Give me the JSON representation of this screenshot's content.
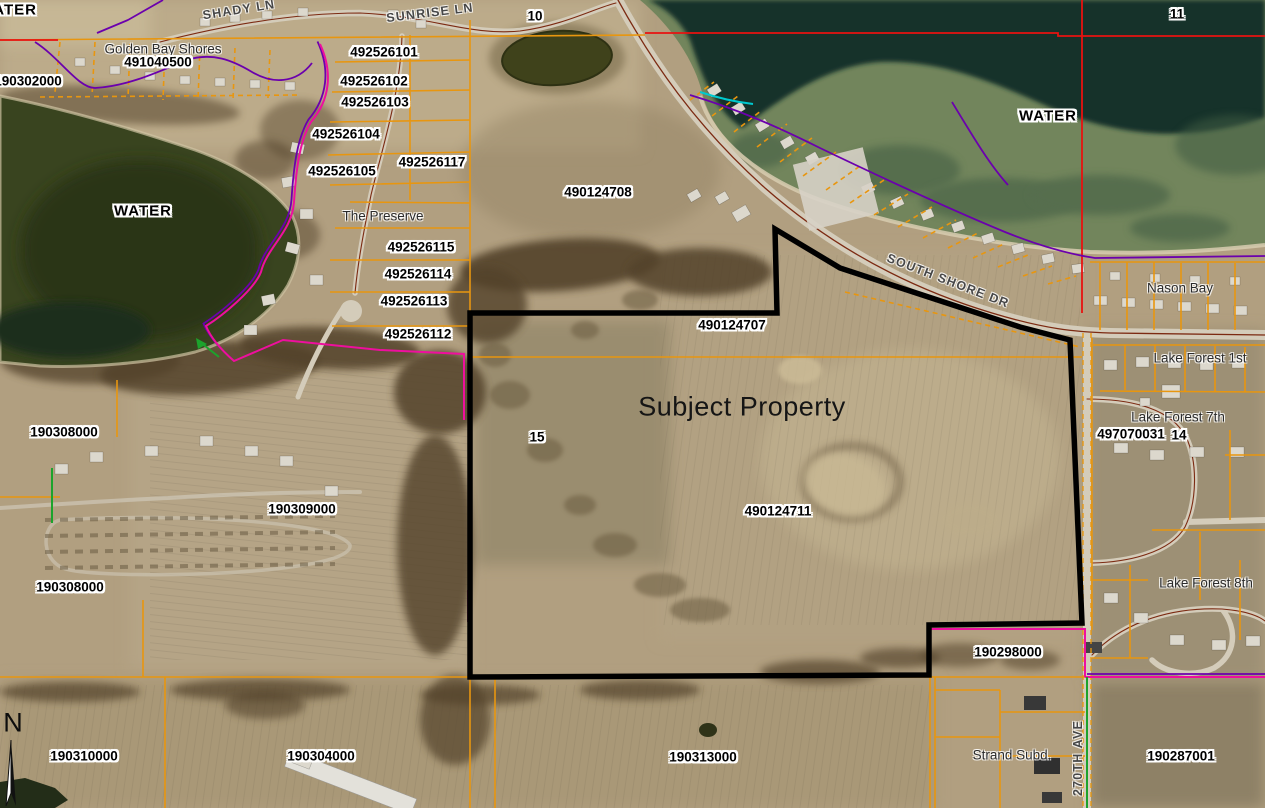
{
  "map": {
    "type": "county-gis-aerial-parcel-map",
    "subject_label": "Subject Property",
    "colors": {
      "parcel_line": "#e8960f",
      "section_line": "#e81210",
      "subdivision_line": "#ee0f9e",
      "plat_line": "#6b00ad",
      "hydro_line": "#00c9cf",
      "row_line": "#1ca32c",
      "subject_outline": "#000000",
      "road_centerline": "#7c2a12",
      "label_text": "#000000",
      "label_halo": "#ffffff"
    },
    "labels": [
      {
        "name": "water-label-top-left",
        "text": "WATER",
        "type": "water",
        "x": 8,
        "y": 10
      },
      {
        "name": "street-shady-ln",
        "text": "SHADY LN",
        "type": "street",
        "x": 239,
        "y": 10,
        "rot": -9
      },
      {
        "name": "street-sunrise-ln",
        "text": "SUNRISE LN",
        "type": "street",
        "x": 430,
        "y": 13,
        "rot": -7
      },
      {
        "name": "section-10",
        "text": "10",
        "type": "section",
        "x": 535,
        "y": 16
      },
      {
        "name": "section-11",
        "text": "11",
        "type": "section",
        "x": 1177,
        "y": 14
      },
      {
        "name": "subdiv-golden-bay-shores",
        "text": "Golden Bay Shores",
        "type": "place",
        "x": 163,
        "y": 49
      },
      {
        "name": "parcel-491040500",
        "text": "491040500",
        "type": "parcel",
        "x": 158,
        "y": 62
      },
      {
        "name": "parcel-190302000",
        "text": "190302000",
        "type": "parcel",
        "x": 28,
        "y": 81
      },
      {
        "name": "parcel-492526101",
        "text": "492526101",
        "type": "parcel",
        "x": 384,
        "y": 52
      },
      {
        "name": "parcel-492526102",
        "text": "492526102",
        "type": "parcel",
        "x": 374,
        "y": 81
      },
      {
        "name": "parcel-492526103",
        "text": "492526103",
        "type": "parcel",
        "x": 375,
        "y": 102
      },
      {
        "name": "parcel-492526104",
        "text": "492526104",
        "type": "parcel",
        "x": 346,
        "y": 134
      },
      {
        "name": "parcel-492526105",
        "text": "492526105",
        "type": "parcel",
        "x": 342,
        "y": 171
      },
      {
        "name": "parcel-492526117",
        "text": "492526117",
        "type": "parcel",
        "x": 432,
        "y": 162
      },
      {
        "name": "water-label-left",
        "text": "WATER",
        "type": "water",
        "x": 143,
        "y": 211
      },
      {
        "name": "water-label-right",
        "text": "WATER",
        "type": "water",
        "x": 1048,
        "y": 116
      },
      {
        "name": "subdiv-the-preserve",
        "text": "The Preserve",
        "type": "place",
        "x": 383,
        "y": 216
      },
      {
        "name": "parcel-492526115",
        "text": "492526115",
        "type": "parcel",
        "x": 421,
        "y": 247
      },
      {
        "name": "parcel-492526114",
        "text": "492526114",
        "type": "parcel",
        "x": 418,
        "y": 274
      },
      {
        "name": "parcel-492526113",
        "text": "492526113",
        "type": "parcel",
        "x": 414,
        "y": 301
      },
      {
        "name": "parcel-492526112",
        "text": "492526112",
        "type": "parcel",
        "x": 418,
        "y": 334
      },
      {
        "name": "parcel-490124708",
        "text": "490124708",
        "type": "parcel",
        "x": 598,
        "y": 192
      },
      {
        "name": "street-south-shore-dr",
        "text": "SOUTH SHORE DR",
        "type": "street",
        "x": 948,
        "y": 281,
        "rot": 21
      },
      {
        "name": "parcel-490124707",
        "text": "490124707",
        "type": "parcel",
        "x": 732,
        "y": 325
      },
      {
        "name": "subdiv-nason-bay",
        "text": "Nason Bay",
        "type": "place",
        "x": 1180,
        "y": 288
      },
      {
        "name": "subdiv-lake-forest-1st",
        "text": "Lake Forest 1st",
        "type": "place",
        "x": 1200,
        "y": 358
      },
      {
        "name": "section-15",
        "text": "15",
        "type": "section",
        "x": 537,
        "y": 437
      },
      {
        "name": "subject-property-title",
        "text": "Subject Property",
        "type": "title",
        "x": 742,
        "y": 407
      },
      {
        "name": "subdiv-lake-forest-7th",
        "text": "Lake Forest 7th",
        "type": "place",
        "x": 1178,
        "y": 417
      },
      {
        "name": "parcel-497070031",
        "text": "497070031",
        "type": "parcel",
        "x": 1131,
        "y": 434
      },
      {
        "name": "section-14",
        "text": "14",
        "type": "section",
        "x": 1179,
        "y": 435
      },
      {
        "name": "parcel-490124711",
        "text": "490124711",
        "type": "parcel",
        "x": 778,
        "y": 511
      },
      {
        "name": "parcel-190308000-north",
        "text": "190308000",
        "type": "parcel",
        "x": 64,
        "y": 432
      },
      {
        "name": "parcel-190309000",
        "text": "190309000",
        "type": "parcel",
        "x": 302,
        "y": 509
      },
      {
        "name": "parcel-190308000-south",
        "text": "190308000",
        "type": "parcel",
        "x": 70,
        "y": 587
      },
      {
        "name": "subdiv-lake-forest-8th",
        "text": "Lake Forest 8th",
        "type": "place",
        "x": 1206,
        "y": 583
      },
      {
        "name": "parcel-190298000",
        "text": "190298000",
        "type": "parcel",
        "x": 1008,
        "y": 652
      },
      {
        "name": "compass-n",
        "text": "N",
        "type": "compass",
        "x": 13,
        "y": 723
      },
      {
        "name": "parcel-190310000",
        "text": "190310000",
        "type": "parcel",
        "x": 84,
        "y": 756
      },
      {
        "name": "parcel-190304000",
        "text": "190304000",
        "type": "parcel",
        "x": 321,
        "y": 756
      },
      {
        "name": "parcel-190313000",
        "text": "190313000",
        "type": "parcel",
        "x": 703,
        "y": 757
      },
      {
        "name": "subdiv-strand-subd",
        "text": "Strand Subd.",
        "type": "place",
        "x": 1012,
        "y": 755
      },
      {
        "name": "street-270th-ave",
        "text": "270TH AVE",
        "type": "street",
        "x": 1078,
        "y": 758,
        "rot": -90
      },
      {
        "name": "parcel-190287001",
        "text": "190287001",
        "type": "parcel",
        "x": 1181,
        "y": 756
      }
    ]
  }
}
